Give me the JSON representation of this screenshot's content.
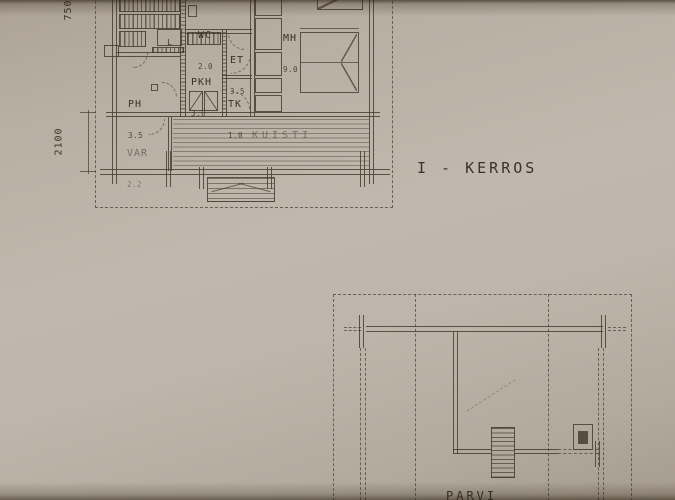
{
  "drawing": {
    "floor1": {
      "title": "I - KERROS",
      "rooms": {
        "ph": {
          "name": "PH",
          "area": "3.5"
        },
        "pkh": {
          "name": "PKH",
          "area": "3.0"
        },
        "wc": {
          "name": "WC",
          "area": "2.0"
        },
        "et": {
          "name": "ET",
          "area": "3.5"
        },
        "tk": {
          "name": "TK",
          "area": "1.0"
        },
        "mh": {
          "name": "MH",
          "area": "9.0"
        },
        "var": {
          "name": "VAR",
          "area": "2.2"
        },
        "kuisti": {
          "name": "KUISTI"
        }
      },
      "stove_label": "L",
      "dimensions": {
        "left_upper": "750",
        "left_lower": "2100"
      }
    },
    "floor2": {
      "title": "PARVI"
    },
    "colors": {
      "paper": "#bcb4a8",
      "ink": "#463e31"
    }
  }
}
